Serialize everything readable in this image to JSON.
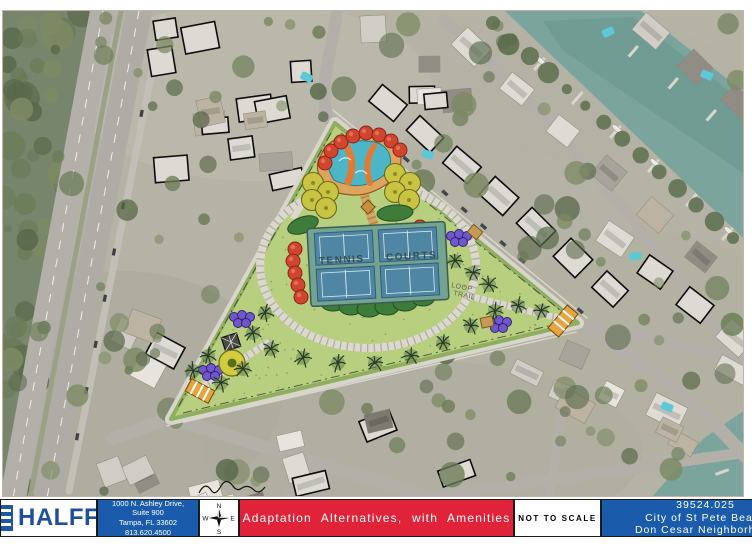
{
  "plan": {
    "labels": {
      "tennis_left": "TENNIS",
      "tennis_right": "COURTS",
      "loop_line1": "LOOP",
      "loop_line2": "TRAIL"
    }
  },
  "footer": {
    "logo": {
      "text": "HALFF",
      "registered_mark": "®"
    },
    "address": {
      "lines": [
        "1000 N. Ashley Drive,",
        "Suite 900",
        "Tampa, FL 33602",
        "813.620.4500"
      ]
    },
    "compass": {
      "n": "N",
      "e": "E",
      "s": "S",
      "w": "W"
    },
    "title_banner": "Adaptation Alternatives, with Amenities",
    "scale_note": "NOT TO SCALE",
    "project": {
      "number": "39524.025",
      "line2": "City of St Pete Beach",
      "line3": "Don Cesar Neighborhood"
    }
  },
  "colors": {
    "banner_red": "#e02339",
    "halff_blue": "#1a5cab",
    "logo_navy": "#1e4f9f",
    "lawn_green": "#b9cf80",
    "court_blue": "#4e86a4",
    "pool_teal": "#4db6c6",
    "water_teal": "#7aa39c"
  }
}
